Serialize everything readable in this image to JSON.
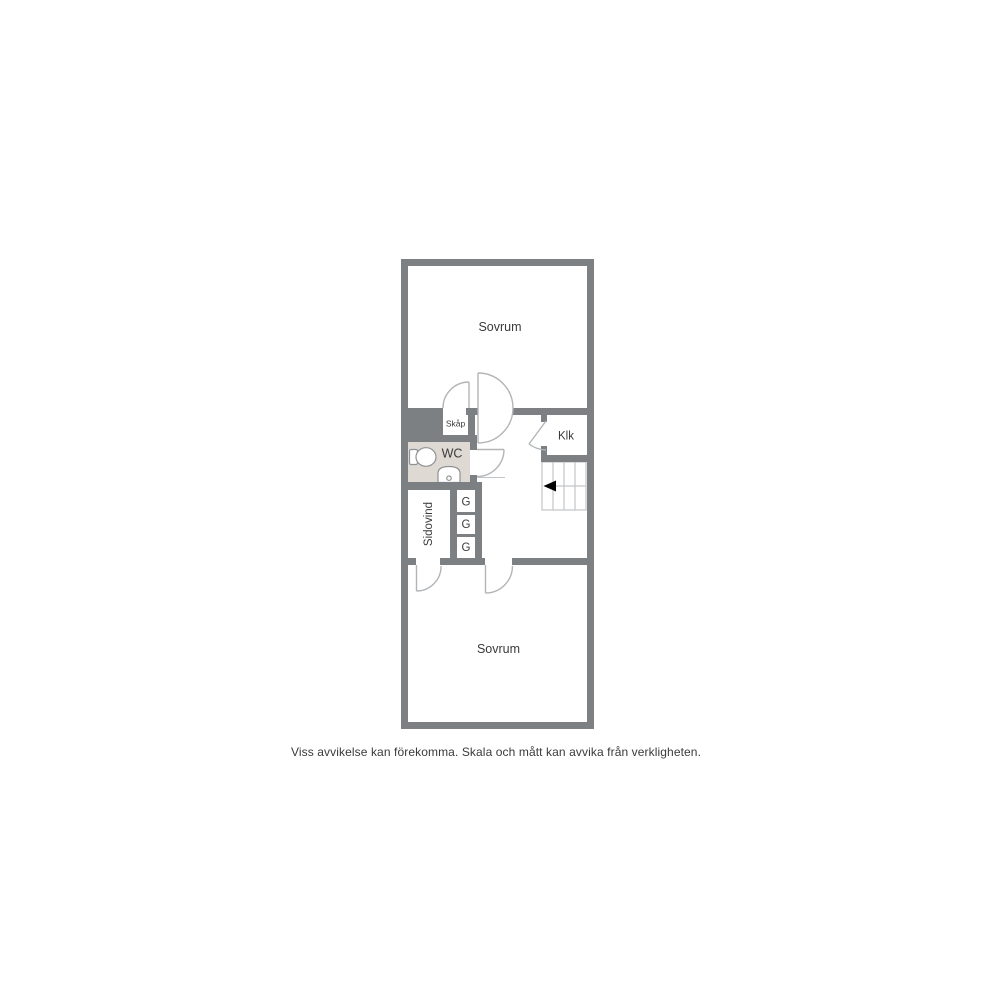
{
  "floor_plan": {
    "rooms": {
      "sovrum_top": {
        "label": "Sovrum"
      },
      "sovrum_bottom": {
        "label": "Sovrum"
      },
      "wc": {
        "label": "WC"
      },
      "skap": {
        "label": "Skåp"
      },
      "klk": {
        "label": "Klk"
      },
      "sidovind": {
        "label": "Sidovind"
      },
      "closet_1": {
        "label": "G"
      },
      "closet_2": {
        "label": "G"
      },
      "closet_3": {
        "label": "G"
      }
    },
    "caption": "Viss avvikelse kan förekomma. Skala och mått kan avvika från verkligheten."
  },
  "colors": {
    "background": "#ffffff",
    "wall": "#7d8083",
    "wc_floor": "#ded9d2",
    "door_stroke": "#b2b5b7",
    "stair_stroke": "#c2c5c7",
    "fixture_stroke": "#8f9294",
    "stair_arrow": "#000000",
    "label_text": "#3a3a3a"
  }
}
